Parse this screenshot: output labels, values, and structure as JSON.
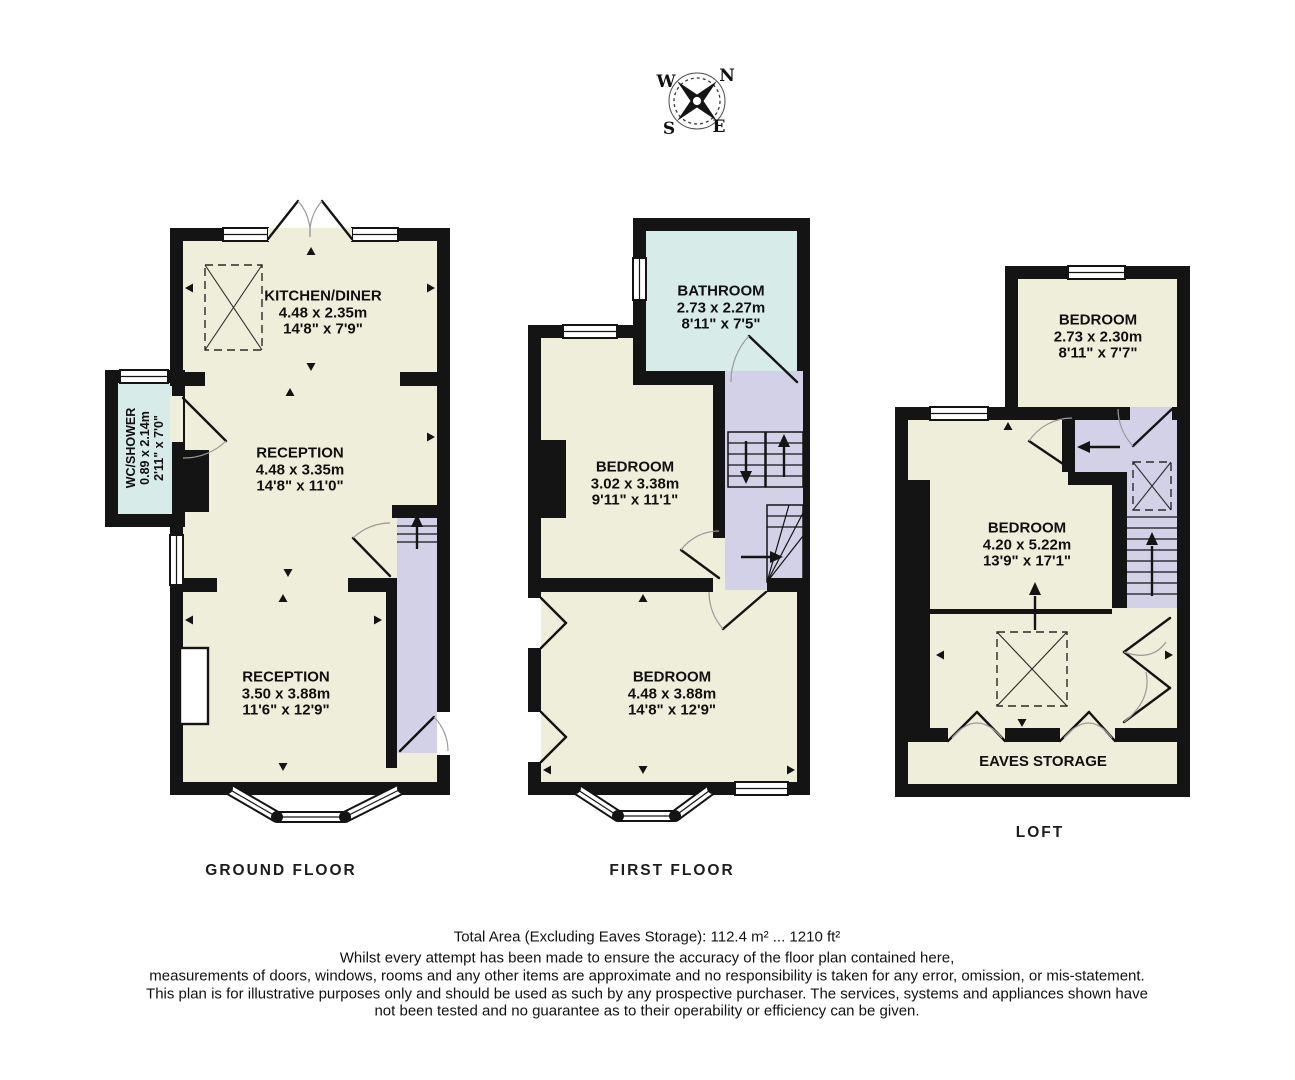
{
  "colors": {
    "page": "#ffffff",
    "wall": "#141414",
    "room": "#efeedb",
    "wet_room": "#d7ebe8",
    "hall_stairs": "#d3d1e8",
    "text": "#111111"
  },
  "compass": {
    "n": "N",
    "w": "W",
    "s": "S",
    "e": "E"
  },
  "floors": [
    {
      "caption": "GROUND FLOOR",
      "rooms": [
        {
          "name": "KITCHEN/DINER",
          "metric": "4.48 x 2.35m",
          "imperial": "14'8\" x 7'9\""
        },
        {
          "name": "RECEPTION",
          "metric": "4.48 x 3.35m",
          "imperial": "14'8\" x 11'0\""
        },
        {
          "name": "RECEPTION",
          "metric": "3.50 x 3.88m",
          "imperial": "11'6\" x 12'9\""
        },
        {
          "name": "WC/SHOWER",
          "metric": "0.89 x 2.14m",
          "imperial": "2'11\" x 7'0\""
        }
      ]
    },
    {
      "caption": "FIRST FLOOR",
      "rooms": [
        {
          "name": "BATHROOM",
          "metric": "2.73 x 2.27m",
          "imperial": "8'11\" x 7'5\""
        },
        {
          "name": "BEDROOM",
          "metric": "3.02 x 3.38m",
          "imperial": "9'11\" x 11'1\""
        },
        {
          "name": "BEDROOM",
          "metric": "4.48 x 3.88m",
          "imperial": "14'8\" x 12'9\""
        }
      ]
    },
    {
      "caption": "LOFT",
      "rooms": [
        {
          "name": "BEDROOM",
          "metric": "2.73 x 2.30m",
          "imperial": "8'11\" x 7'7\""
        },
        {
          "name": "BEDROOM",
          "metric": "4.20 x 5.22m",
          "imperial": "13'9\" x 17'1\""
        },
        {
          "name": "EAVES STORAGE"
        }
      ]
    }
  ],
  "footer": {
    "total_area": "Total Area (Excluding Eaves Storage): 112.4 m² ... 1210 ft²",
    "disclaimer_lines": [
      "Whilst every attempt has been made to ensure the accuracy of the floor plan contained here,",
      "measurements of doors, windows, rooms and any other items are approximate and no responsibility is taken for any error, omission, or mis-statement.",
      "This plan is for illustrative purposes only and should be used as such by any prospective purchaser. The services, systems and appliances shown have",
      "not been tested and no guarantee as to their operability or efficiency can be given."
    ]
  }
}
